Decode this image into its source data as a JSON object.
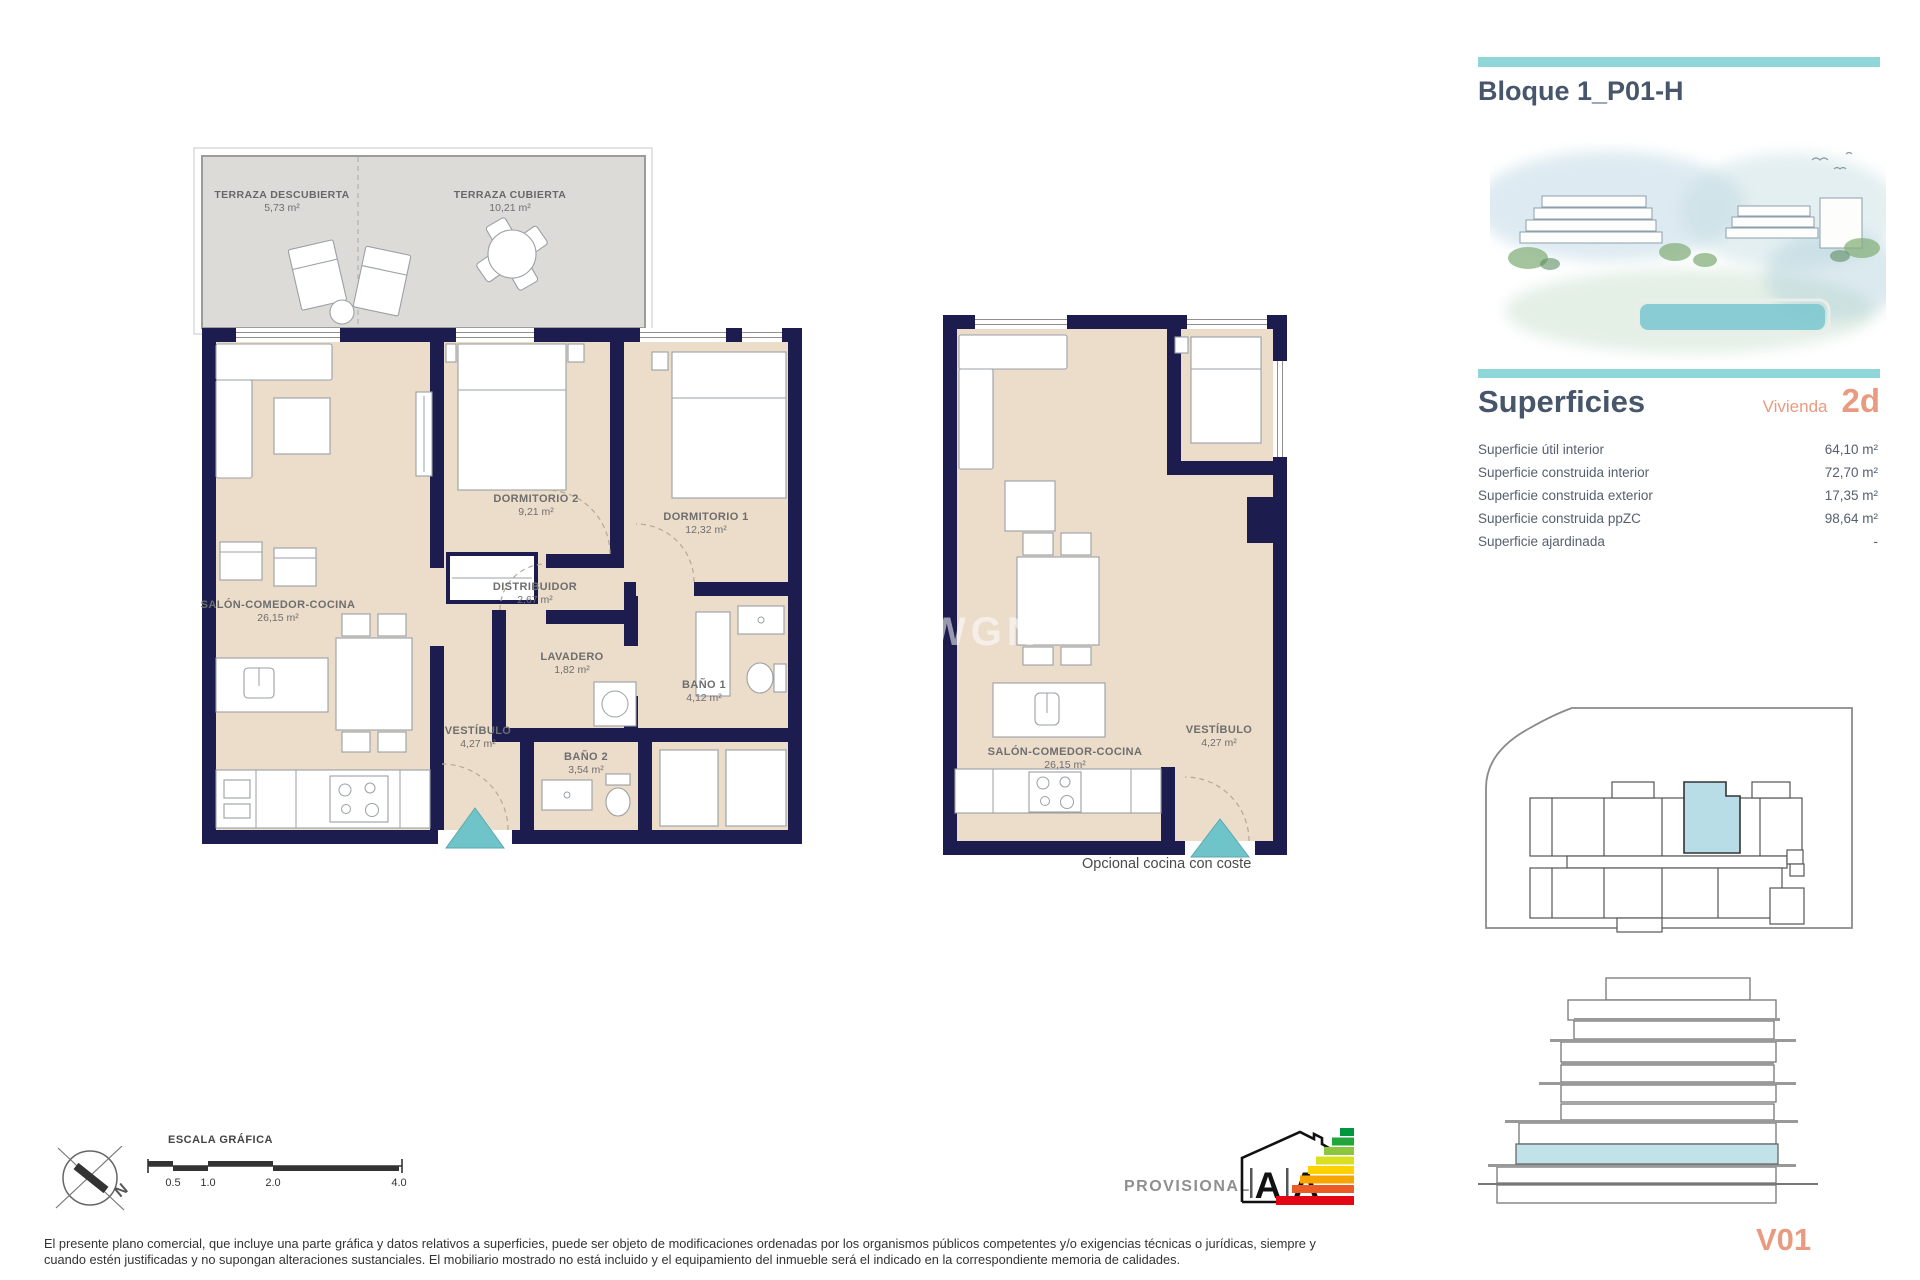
{
  "colors": {
    "teal": "#8fd6d9",
    "teal2": "#6fc4c9",
    "salmon": "#e89b80",
    "navy": "#1c1c4f",
    "beige": "#ecdcca",
    "terrace": "#dcdbd8",
    "slate": "#47566b",
    "highlight": "#b8dde6",
    "highlight2": "#c2e2ea"
  },
  "sidebar": {
    "title": "Bloque 1_P01-H",
    "superficies": {
      "heading": "Superficies",
      "vivienda_label": "Vivienda",
      "vivienda_code": "2d",
      "rows": [
        {
          "label": "Superficie útil interior",
          "value": "64,10 m²"
        },
        {
          "label": "Superficie construida interior",
          "value": "72,70 m²"
        },
        {
          "label": "Superficie construida exterior",
          "value": "17,35 m²"
        },
        {
          "label": "Superficie construida ppZC",
          "value": "98,64 m²"
        },
        {
          "label": "Superficie ajardinada",
          "value": "-"
        }
      ]
    },
    "version": "V01"
  },
  "plan1": {
    "terraza_descubierta": {
      "name": "TERRAZA DESCUBIERTA",
      "area": "5,73 m²"
    },
    "terraza_cubierta": {
      "name": "TERRAZA CUBIERTA",
      "area": "10,21 m²"
    },
    "dormitorio2": {
      "name": "DORMITORIO 2",
      "area": "9,21 m²"
    },
    "dormitorio1": {
      "name": "DORMITORIO 1",
      "area": "12,32 m²"
    },
    "distribuidor": {
      "name": "DISTRIBUIDOR",
      "area": "2,67 m²"
    },
    "lavadero": {
      "name": "LAVADERO",
      "area": "1,82 m²"
    },
    "bano1": {
      "name": "BAÑO 1",
      "area": "4,12 m²"
    },
    "bano2": {
      "name": "BAÑO 2",
      "area": "3,54 m²"
    },
    "salon": {
      "name": "SALÓN-COMEDOR-COCINA",
      "area": "26,15 m²"
    },
    "vestibulo": {
      "name": "VESTÍBULO",
      "area": "4,27 m²"
    }
  },
  "plan2": {
    "salon": {
      "name": "SALÓN-COMEDOR-COCINA",
      "area": "26,15 m²"
    },
    "vestibulo": {
      "name": "VESTÍBULO",
      "area": "4,27 m²"
    },
    "caption": "Opcional cocina con coste"
  },
  "watermark": "WGN",
  "footer": {
    "escala_label": "ESCALA GRÁFICA",
    "scale_ticks": [
      "0.5",
      "1.0",
      "2.0",
      "4.0"
    ],
    "provisional": "PROVISIONAL",
    "compass_letter": "N",
    "energy_letter_left": "A",
    "energy_letter_right": "A",
    "disclaimer_line1": "El presente plano comercial, que incluye una parte gráfica y datos relativos a superficies, puede ser objeto de modificaciones ordenadas por los organismos públicos competentes y/o exigencias técnicas o jurídicas, siempre y",
    "disclaimer_line2": "cuando estén justificadas y no supongan alteraciones sustanciales. El mobiliario mostrado no está incluido y el equipamiento del inmueble será el indicado en la correspondiente memoria de calidades."
  }
}
